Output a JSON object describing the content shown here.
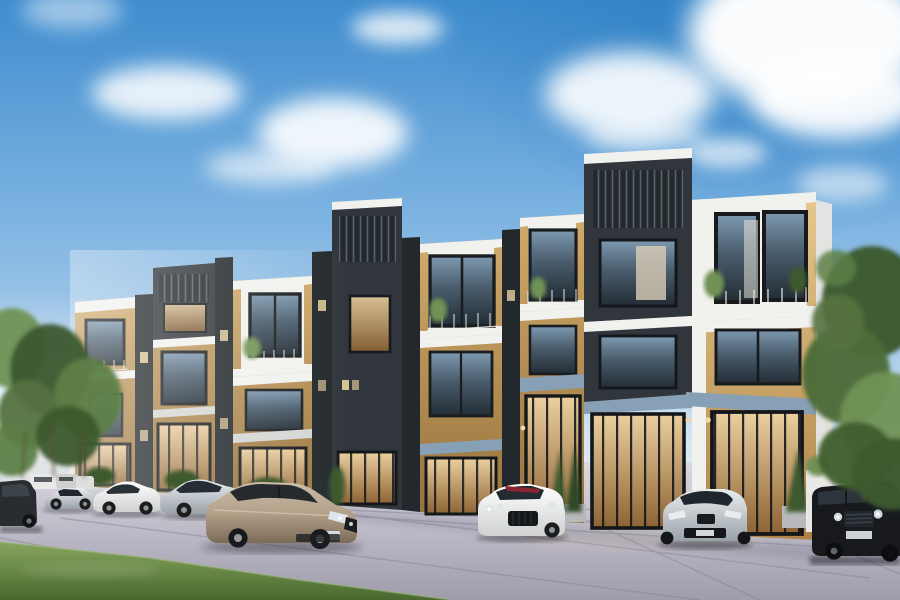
{
  "meta": {
    "type": "architectural-exterior-render",
    "description": "Daytime photorealistic rendering of a modern three-storey townhouse row with staggered charcoal and white box facades, wood panel accents, glass storefront ground floor, luxury cars parked on a paved forecourt, trees at both sides, blue sky with scattered white clouds",
    "width_px": 900,
    "height_px": 600,
    "visible_text": "none"
  },
  "palette": {
    "sky_top": "#2e7fc4",
    "sky_mid": "#79b1e0",
    "sky_horizon": "#e9f1f6",
    "cloud_white": "#ffffff",
    "charcoal": "#30363b",
    "charcoal_dark": "#23282c",
    "slat_gray": "#59626a",
    "frame_white": "#f1f1ee",
    "slab_shadow": "#d4d6d4",
    "wood_light": "#e6c98f",
    "wood_dark": "#b08448",
    "fascia_blue": "#87a0b5",
    "glass_dark": "#222c34",
    "glass_sky": "#7e9ab1",
    "glass_warm_hi": "#ecd0a0",
    "glass_warm_lo": "#8d6334",
    "pavement_far": "#dcd9e1",
    "pavement_near": "#9f9cab",
    "joint_gray": "#7e7a8c",
    "grass_light": "#86a65e",
    "grass_dark": "#49682f",
    "tree_light": "#6f9254",
    "tree_dark": "#3c5a2e",
    "car_white": "#f4f4f2",
    "car_silver": "#c8cdd2",
    "car_champagne": "#b3a18a",
    "car_black": "#17191c",
    "car_gray_dark": "#2a2d2f",
    "light_warm": "#f3d9a4"
  },
  "scene": {
    "sky": {
      "clouds_count": 11,
      "brightest_cloud_region": "top-right",
      "haze": "white haze at left horizon"
    },
    "buildings": {
      "units": [
        {
          "id": 1,
          "style": "wood-box-white-frame",
          "relative_height": "lowest (farthest left)"
        },
        {
          "id": 2,
          "style": "charcoal-box-over-wood"
        },
        {
          "id": 3,
          "style": "white-frame-wood-balcony"
        },
        {
          "id": 4,
          "style": "charcoal-tower-slat-roofdeck"
        },
        {
          "id": 5,
          "style": "white-frame-wood-double-window"
        },
        {
          "id": 6,
          "style": "white-frame-wood-balcony"
        },
        {
          "id": 7,
          "style": "tall-charcoal-tower-slat-roofdeck"
        },
        {
          "id": 8,
          "style": "white-frame-wood-balcony (tallest, nearest right)"
        }
      ],
      "floors_visible": 3,
      "ground_floor": "full-height black-mullion glass storefronts with warm interior light",
      "details": [
        "balcony railings",
        "balcony plants",
        "wall sconces",
        "blue-gray fascia bands",
        "hedges and conical shrubs in planters"
      ]
    },
    "vehicles": [
      {
        "id": "suv-dark-left",
        "color": "dark gray",
        "view": "rear-side",
        "position": "far left edge"
      },
      {
        "id": "distant-small-cars",
        "color": "white / gray",
        "view": "distant",
        "position": "behind left row"
      },
      {
        "id": "supercar-silver",
        "color": "silver",
        "view": "side",
        "position": "left row"
      },
      {
        "id": "coupe-white-side",
        "color": "white",
        "view": "side",
        "position": "left row"
      },
      {
        "id": "sedan-silver",
        "color": "silver",
        "view": "side 3/4",
        "position": "left row"
      },
      {
        "id": "sedan-champagne-foreground",
        "color": "champagne bronze",
        "view": "front 3/4",
        "position": "center-left foreground (largest)"
      },
      {
        "id": "coupe-white-front",
        "color": "white with red cabin accent",
        "view": "front 3/4",
        "position": "center"
      },
      {
        "id": "sports-silver-front",
        "color": "silver",
        "view": "front",
        "position": "center-right"
      },
      {
        "id": "suv-black-right",
        "color": "black",
        "view": "front 3/4",
        "position": "right edge, partly cropped"
      }
    ],
    "vegetation": {
      "left_trees": "cluster of leafy green trees at left edge",
      "right_tree": "tall leafy tree in front of right building corner",
      "hedges": "low hedges at storefront bases",
      "shrubs": "conical shrubs in gray and white planters"
    },
    "ground": {
      "surface": "large paver plaza, lavender-gray, diagonal joint lines",
      "grass": "green lawn wedge in bottom-left corner",
      "shadows": "soft shadows under cars and along building base"
    }
  }
}
